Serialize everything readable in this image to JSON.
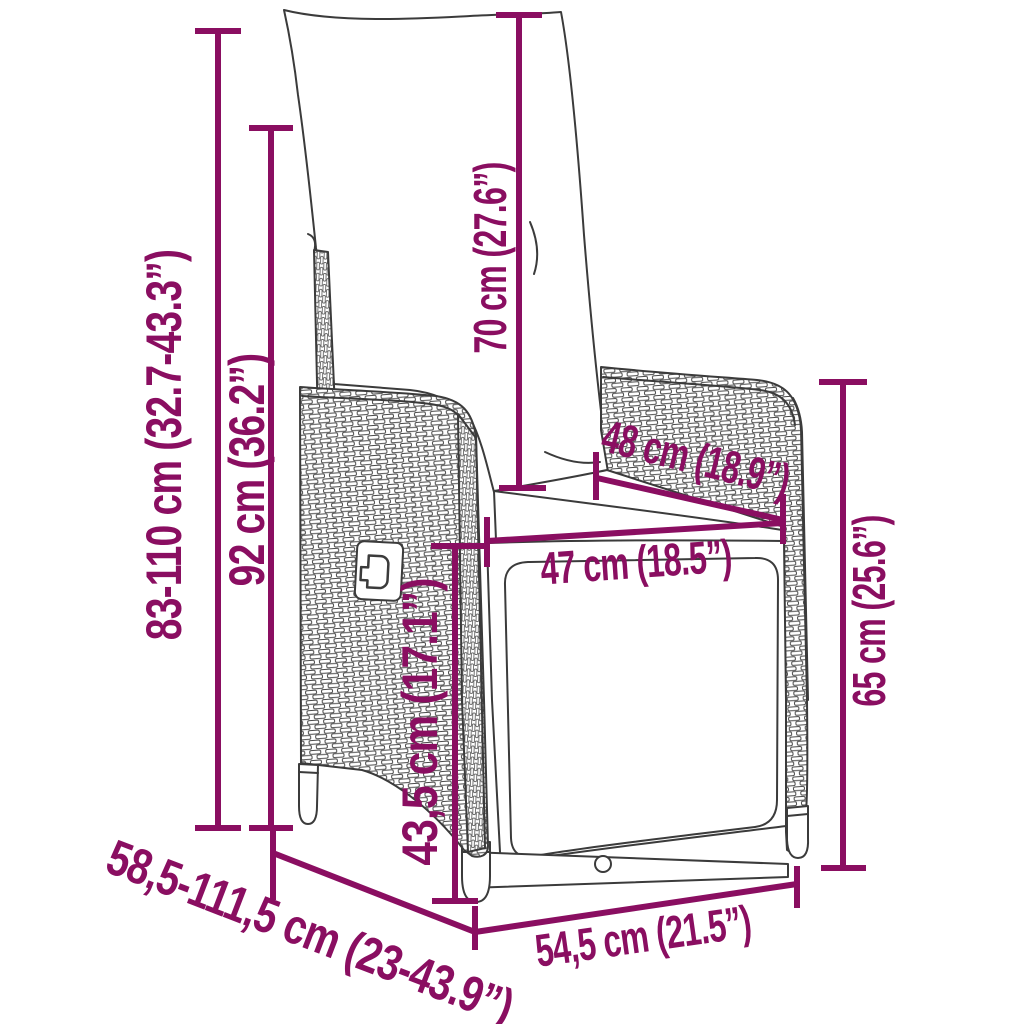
{
  "page": {
    "background": "#ffffff"
  },
  "diagram": {
    "subject": "reclining poly rattan garden chair with cushions - dimension drawing",
    "accent_color": "#8a0e61",
    "drawing_color": "#3b3b3b",
    "dimensions": [
      {
        "id": "total-height-range",
        "label": "83-110 cm (32.7-43.3”)",
        "orientation": "vertical"
      },
      {
        "id": "backrest-height",
        "label": "92 cm (36.2”)",
        "orientation": "vertical"
      },
      {
        "id": "back-cushion-height",
        "label": "70 cm (27.6”)",
        "orientation": "vertical"
      },
      {
        "id": "seat-depth",
        "label": "48 cm (18.9”)",
        "orientation": "diagonal"
      },
      {
        "id": "seat-width",
        "label": "47 cm (18.5”)",
        "orientation": "horizontal"
      },
      {
        "id": "armrest-height",
        "label": "65 cm (25.6”)",
        "orientation": "vertical"
      },
      {
        "id": "seat-height",
        "label": "43,5 cm (17.1”)",
        "orientation": "vertical"
      },
      {
        "id": "total-depth-range",
        "label": "58,5-111,5 cm (23-43.9”)",
        "orientation": "diagonal"
      },
      {
        "id": "base-width",
        "label": "54,5 cm (21.5”)",
        "orientation": "horizontal"
      }
    ]
  }
}
